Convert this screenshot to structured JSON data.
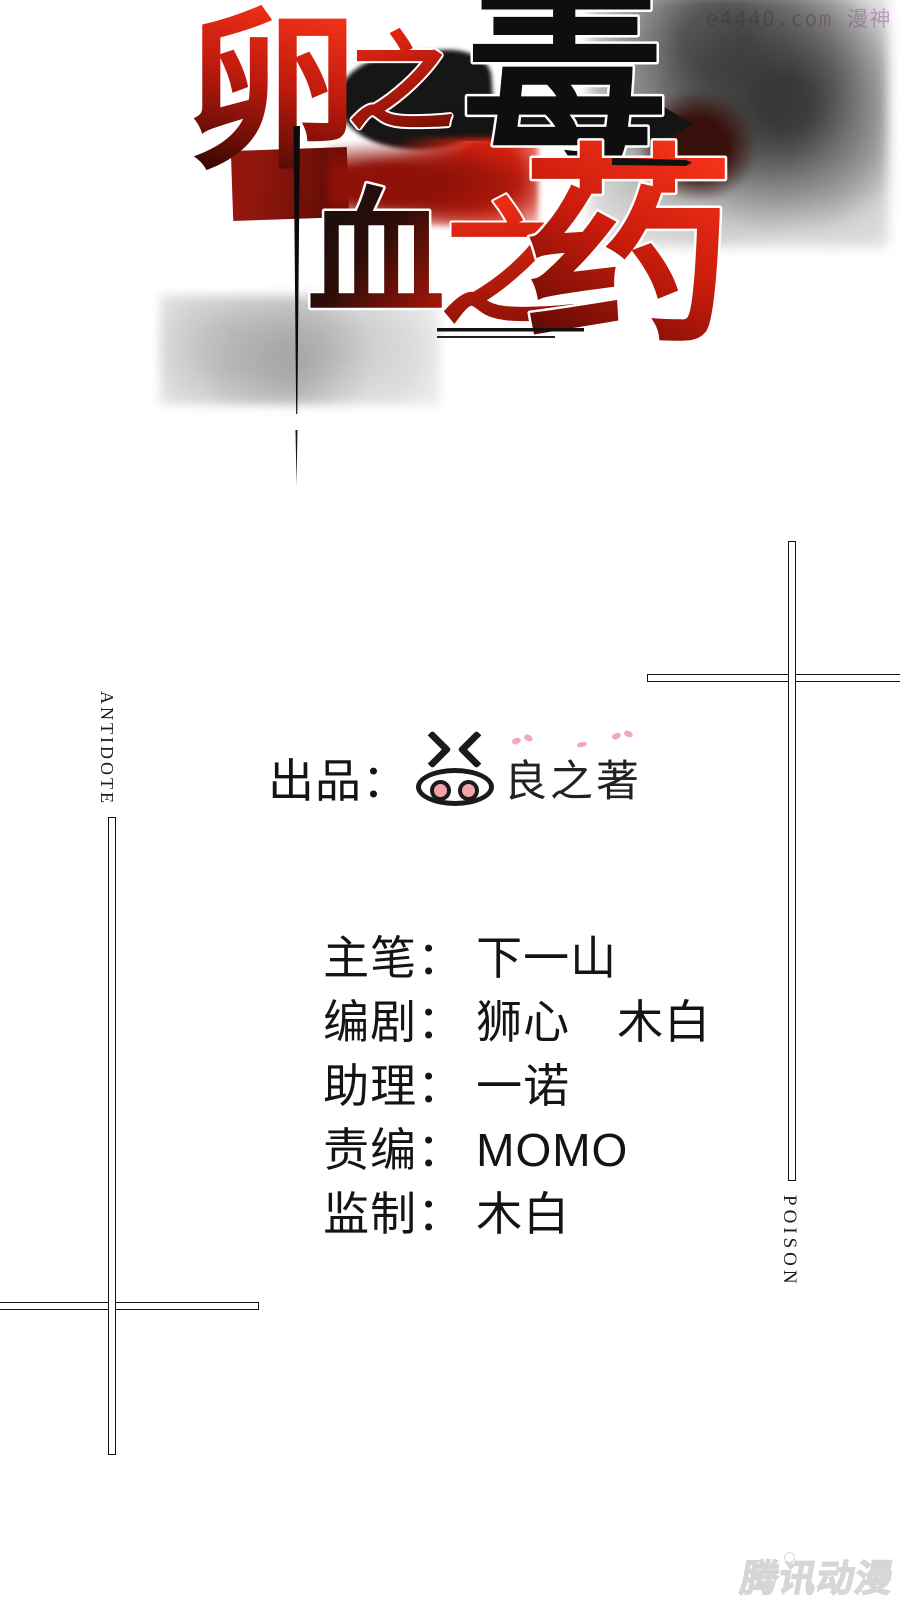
{
  "page": {
    "background": "#ffffff"
  },
  "site_watermark": {
    "text": "e4440.com 漫神",
    "color": "#d0a0d4"
  },
  "title": {
    "full_text": "卵之毒 血之药",
    "char_luan": "卵",
    "char_zhi1": "之",
    "char_du": "毒",
    "char_xue": "血",
    "char_zhi2": "之",
    "char_yao": "药",
    "colors": {
      "red_bright": "#ee2a14",
      "red_mid": "#b01408",
      "red_dark": "#5c0a04",
      "ink_black": "#111111"
    }
  },
  "side_labels": {
    "left_vertical": "ANTIDOTE",
    "right_vertical": "POISON"
  },
  "credits": {
    "producer": {
      "label": "出品：",
      "name": "良之著",
      "logo": "pig-face-icon",
      "accent_pink": "#f2aab8"
    },
    "rows": [
      {
        "label": "主笔：",
        "value": "下一山"
      },
      {
        "label": "编剧：",
        "value": "狮心　木白"
      },
      {
        "label": "助理：",
        "value": "一诺"
      },
      {
        "label": "责编：",
        "value": "MOMO"
      },
      {
        "label": "监制：",
        "value": "木白"
      }
    ]
  },
  "publisher_watermark": {
    "text": "腾讯动漫"
  }
}
